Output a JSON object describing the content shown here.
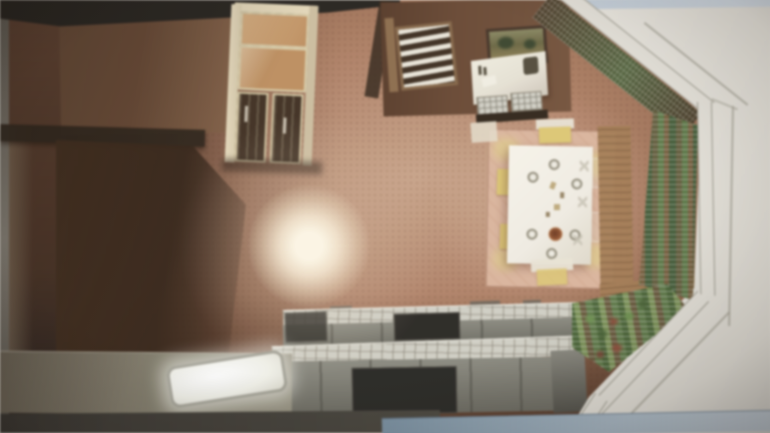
{
  "scene": {
    "type": "photo-of-3d-interior-rendering",
    "orientation": "render rotated 90 degrees, photographed off a screen with glare",
    "room": "kitchen and dining room, overhead cutaway view",
    "notes": "no visible text anywhere in the image"
  },
  "objects": [
    {
      "name": "china-hutch",
      "desc": "tall cabinet with warm upper glass panes and dark lower glass doors"
    },
    {
      "name": "blinds-window",
      "desc": "small window/door with white horizontal slat blinds on brown wall"
    },
    {
      "name": "framed-picture",
      "desc": "dark-framed landscape painting on far wall"
    },
    {
      "name": "white-buffet",
      "desc": "white-topped cabinet with small items and two tiled drawers"
    },
    {
      "name": "dining-table",
      "desc": "white table seen from above with six plates, centerpiece food and glasses"
    },
    {
      "name": "chairs",
      "desc": "chairs with yellow seat cushions around the table"
    },
    {
      "name": "area-rug",
      "desc": "pale pink rug with yellow corner patches under the table"
    },
    {
      "name": "bay-window",
      "desc": "angled corner bay with garden greenery outside, white cutaway wall bands and thin wireframe outlines"
    },
    {
      "name": "kitchen-counters",
      "desc": "two tiled-top counter runs with gray cabinet faces, dark cooktop and open bay"
    },
    {
      "name": "sink",
      "desc": "bright white basin on left counter"
    },
    {
      "name": "lens-glare",
      "desc": "warm bright reflection spot on the floor area"
    },
    {
      "name": "bottom-blue-bar",
      "desc": "blue-gray strip along bottom edge of the photographed screen"
    },
    {
      "name": "top-light-sliver",
      "desc": "pale blue sliver along top-right edge"
    }
  ],
  "palette": {
    "bg_outer": "#e8e5dd",
    "sliver_blue": "#c6d2de",
    "taskbar_blue": "#7b93a6",
    "taskbar_blue_light": "#c2cfda",
    "floor_light": "#cda68a",
    "floor_mid": "#b48367",
    "floor_dark": "#7e543c",
    "wall_brown": "#6e4c36",
    "ceiling_dark": "#2b2722",
    "cabinet_cream": "#ddcfae",
    "hutch_glass_warm": "#c3915f",
    "hutch_glass_dark": "#453425",
    "blinds_white": "#ece7da",
    "picture_green": "#6e6a44",
    "buffet_white": "#e9e4d6",
    "rug_pink": "#dfb79e",
    "table_white": "#f3eee4",
    "chair_yellow": "#e2ca72",
    "pie_brown": "#a05c36",
    "counter_gray": "#8e8d82",
    "tile_light": "#d3d1c6",
    "sink_white": "#ffffff",
    "wood_sill": "#a97f55",
    "foliage_green": "#5f7c48",
    "foliage_dark": "#46603a",
    "band_hatch": "#4e3e2a",
    "cut_white": "#e8e5dc",
    "outline_gray": "#a9a598",
    "dark_strip": "#3a3731",
    "glare_warm": "#fff8e6"
  }
}
